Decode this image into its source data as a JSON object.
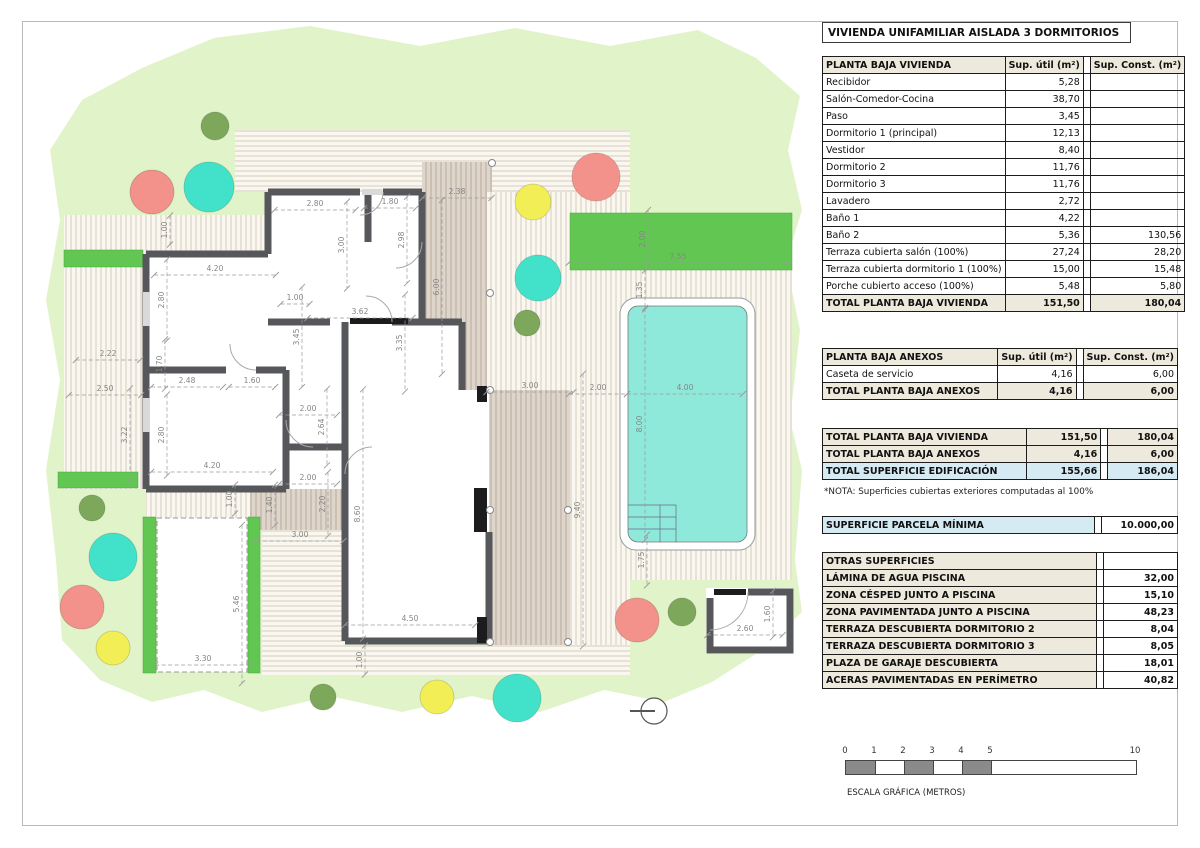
{
  "title": "VIVIENDA UNIFAMILIAR AISLADA 3 DORMITORIOS",
  "col_headers": {
    "util": "Sup. útil\n(m²)",
    "const": "Sup. Const.\n(m²)"
  },
  "vivienda": {
    "name": "PLANTA BAJA VIVIENDA",
    "rows": [
      [
        "Recibidor",
        "5,28",
        ""
      ],
      [
        "Salón-Comedor-Cocina",
        "38,70",
        ""
      ],
      [
        "Paso",
        "3,45",
        ""
      ],
      [
        "Dormitorio 1 (principal)",
        "12,13",
        ""
      ],
      [
        "Vestidor",
        "8,40",
        ""
      ],
      [
        "Dormitorio 2",
        "11,76",
        ""
      ],
      [
        "Dormitorio 3",
        "11,76",
        ""
      ],
      [
        "Lavadero",
        "2,72",
        ""
      ],
      [
        "Baño 1",
        "4,22",
        ""
      ],
      [
        "Baño 2",
        "5,36",
        "130,56"
      ],
      [
        "Terraza cubierta salón (100%)",
        "27,24",
        "28,20"
      ],
      [
        "Terraza cubierta dormitorio 1 (100%)",
        "15,00",
        "15,48"
      ],
      [
        "Porche cubierto acceso (100%)",
        "5,48",
        "5,80"
      ]
    ],
    "total": [
      "TOTAL PLANTA BAJA VIVIENDA",
      "151,50",
      "180,04"
    ]
  },
  "anexos": {
    "name": "PLANTA BAJA ANEXOS",
    "rows": [
      [
        "Caseta de servicio",
        "4,16",
        "6,00"
      ]
    ],
    "total": [
      "TOTAL PLANTA BAJA ANEXOS",
      "4,16",
      "6,00"
    ]
  },
  "totales": {
    "rows": [
      [
        "TOTAL PLANTA BAJA VIVIENDA",
        "151,50",
        "180,04"
      ],
      [
        "TOTAL PLANTA BAJA ANEXOS",
        "4,16",
        "6,00"
      ],
      [
        "TOTAL SUPERFICIE EDIFICACIÓN",
        "155,66",
        "186,04"
      ]
    ],
    "nota": "*NOTA: Superficies cubiertas exteriores computadas al 100%"
  },
  "parcela": {
    "label": "SUPERFICIE PARCELA MÍNIMA",
    "value": "10.000,00"
  },
  "otras": {
    "name": "OTRAS SUPERFICIES",
    "rows": [
      [
        "LÁMINA DE AGUA PISCINA",
        "32,00"
      ],
      [
        "ZONA CÉSPED JUNTO A PISCINA",
        "15,10"
      ],
      [
        "ZONA PAVIMENTADA JUNTO A PISCINA",
        "48,23"
      ],
      [
        "TERRAZA DESCUBIERTA DORMITORIO 2",
        "8,04"
      ],
      [
        "TERRAZA DESCUBIERTA DORMITORIO 3",
        "8,05"
      ],
      [
        "PLAZA DE GARAJE DESCUBIERTA",
        "18,01"
      ],
      [
        "ACERAS PAVIMENTADAS EN PERÍMETRO",
        "40,82"
      ]
    ]
  },
  "scale": {
    "ticks": [
      "0",
      "1",
      "2",
      "3",
      "4",
      "5",
      "10"
    ],
    "px_per_m": 29,
    "filled_segments": [
      [
        0,
        1
      ],
      [
        2,
        3
      ],
      [
        4,
        5
      ]
    ],
    "caption": "ESCALA GRÁFICA (METROS)"
  },
  "colors": {
    "plot_green": "#e1f3c8",
    "hedge_green": "#62c653",
    "pool_cyan": "#8fe9da",
    "wall_gray": "#55575a",
    "header_beige": "#ede9dc",
    "highlight_blue": "#d5eaf3",
    "seg_gray": "#8a8a8a",
    "tree": {
      "red": "#f2928a",
      "teal": "#42e2ca",
      "yellow": "#f2ee55",
      "olive": "#7da75b"
    }
  },
  "trees": [
    {
      "x": 215,
      "y": 126,
      "r": 14,
      "c": "olive"
    },
    {
      "x": 152,
      "y": 192,
      "r": 22,
      "c": "red"
    },
    {
      "x": 209,
      "y": 187,
      "r": 25,
      "c": "teal"
    },
    {
      "x": 533,
      "y": 202,
      "r": 18,
      "c": "yellow"
    },
    {
      "x": 596,
      "y": 177,
      "r": 24,
      "c": "red"
    },
    {
      "x": 538,
      "y": 278,
      "r": 23,
      "c": "teal"
    },
    {
      "x": 527,
      "y": 323,
      "r": 13,
      "c": "olive"
    },
    {
      "x": 92,
      "y": 508,
      "r": 13,
      "c": "olive"
    },
    {
      "x": 113,
      "y": 557,
      "r": 24,
      "c": "teal"
    },
    {
      "x": 82,
      "y": 607,
      "r": 22,
      "c": "red"
    },
    {
      "x": 113,
      "y": 648,
      "r": 17,
      "c": "yellow"
    },
    {
      "x": 323,
      "y": 697,
      "r": 13,
      "c": "olive"
    },
    {
      "x": 437,
      "y": 697,
      "r": 17,
      "c": "yellow"
    },
    {
      "x": 517,
      "y": 698,
      "r": 24,
      "c": "teal"
    },
    {
      "x": 637,
      "y": 620,
      "r": 22,
      "c": "red"
    },
    {
      "x": 682,
      "y": 612,
      "r": 14,
      "c": "olive"
    }
  ],
  "posts": [
    [
      492,
      163
    ],
    [
      490,
      293
    ],
    [
      490,
      390
    ],
    [
      490,
      510
    ],
    [
      568,
      510
    ],
    [
      490,
      642
    ],
    [
      568,
      642
    ]
  ],
  "dimensions": [
    {
      "v": "2.38",
      "x": 457,
      "y": 193,
      "o": "h"
    },
    {
      "v": "2.80",
      "x": 315,
      "y": 205,
      "o": "h"
    },
    {
      "v": "1.80",
      "x": 390,
      "y": 203,
      "o": "h"
    },
    {
      "v": "3.00",
      "x": 342,
      "y": 245,
      "o": "v"
    },
    {
      "v": "2.98",
      "x": 402,
      "y": 240,
      "o": "v"
    },
    {
      "v": "1.00",
      "x": 165,
      "y": 230,
      "o": "v"
    },
    {
      "v": "4.20",
      "x": 215,
      "y": 270,
      "o": "h"
    },
    {
      "v": "2.80",
      "x": 162,
      "y": 300,
      "o": "v"
    },
    {
      "v": "1.00",
      "x": 295,
      "y": 299,
      "o": "h"
    },
    {
      "v": "3.62",
      "x": 360,
      "y": 313,
      "o": "h"
    },
    {
      "v": "3.45",
      "x": 297,
      "y": 337,
      "o": "v"
    },
    {
      "v": "3.35",
      "x": 400,
      "y": 343,
      "o": "v"
    },
    {
      "v": "6.00",
      "x": 437,
      "y": 287,
      "o": "v"
    },
    {
      "v": "2.22",
      "x": 108,
      "y": 355,
      "o": "h"
    },
    {
      "v": "2.50",
      "x": 105,
      "y": 390,
      "o": "h"
    },
    {
      "v": "3.22",
      "x": 125,
      "y": 435,
      "o": "v"
    },
    {
      "v": "1.70",
      "x": 160,
      "y": 364,
      "o": "v"
    },
    {
      "v": "2.48",
      "x": 187,
      "y": 382,
      "o": "h"
    },
    {
      "v": "1.60",
      "x": 252,
      "y": 382,
      "o": "h"
    },
    {
      "v": "2.80",
      "x": 162,
      "y": 435,
      "o": "v"
    },
    {
      "v": "4.20",
      "x": 212,
      "y": 467,
      "o": "h"
    },
    {
      "v": "2.00",
      "x": 308,
      "y": 410,
      "o": "h"
    },
    {
      "v": "2.64",
      "x": 322,
      "y": 427,
      "o": "v"
    },
    {
      "v": "2.00",
      "x": 308,
      "y": 479,
      "o": "h"
    },
    {
      "v": "2.20",
      "x": 323,
      "y": 504,
      "o": "v"
    },
    {
      "v": "8.60",
      "x": 358,
      "y": 514,
      "o": "v"
    },
    {
      "v": "3.00",
      "x": 300,
      "y": 536,
      "o": "h"
    },
    {
      "v": "4.50",
      "x": 410,
      "y": 620,
      "o": "h"
    },
    {
      "v": "1.00",
      "x": 360,
      "y": 660,
      "o": "v"
    },
    {
      "v": "9.40",
      "x": 578,
      "y": 510,
      "o": "v"
    },
    {
      "v": "1.00",
      "x": 230,
      "y": 499,
      "o": "v"
    },
    {
      "v": "1.40",
      "x": 270,
      "y": 505,
      "o": "v"
    },
    {
      "v": "3.00",
      "x": 530,
      "y": 387,
      "o": "h"
    },
    {
      "v": "2.00",
      "x": 598,
      "y": 389,
      "o": "h"
    },
    {
      "v": "2.00",
      "x": 643,
      "y": 239,
      "o": "v"
    },
    {
      "v": "7.55",
      "x": 678,
      "y": 258,
      "o": "h"
    },
    {
      "v": "1.35",
      "x": 640,
      "y": 290,
      "o": "v"
    },
    {
      "v": "4.00",
      "x": 685,
      "y": 389,
      "o": "h"
    },
    {
      "v": "8.00",
      "x": 640,
      "y": 424,
      "o": "v"
    },
    {
      "v": "1.75",
      "x": 642,
      "y": 560,
      "o": "v"
    },
    {
      "v": "2.60",
      "x": 745,
      "y": 630,
      "o": "h"
    },
    {
      "v": "1.60",
      "x": 768,
      "y": 614,
      "o": "v"
    },
    {
      "v": "5.46",
      "x": 237,
      "y": 604,
      "o": "v"
    },
    {
      "v": "3.30",
      "x": 203,
      "y": 660,
      "o": "h"
    }
  ]
}
